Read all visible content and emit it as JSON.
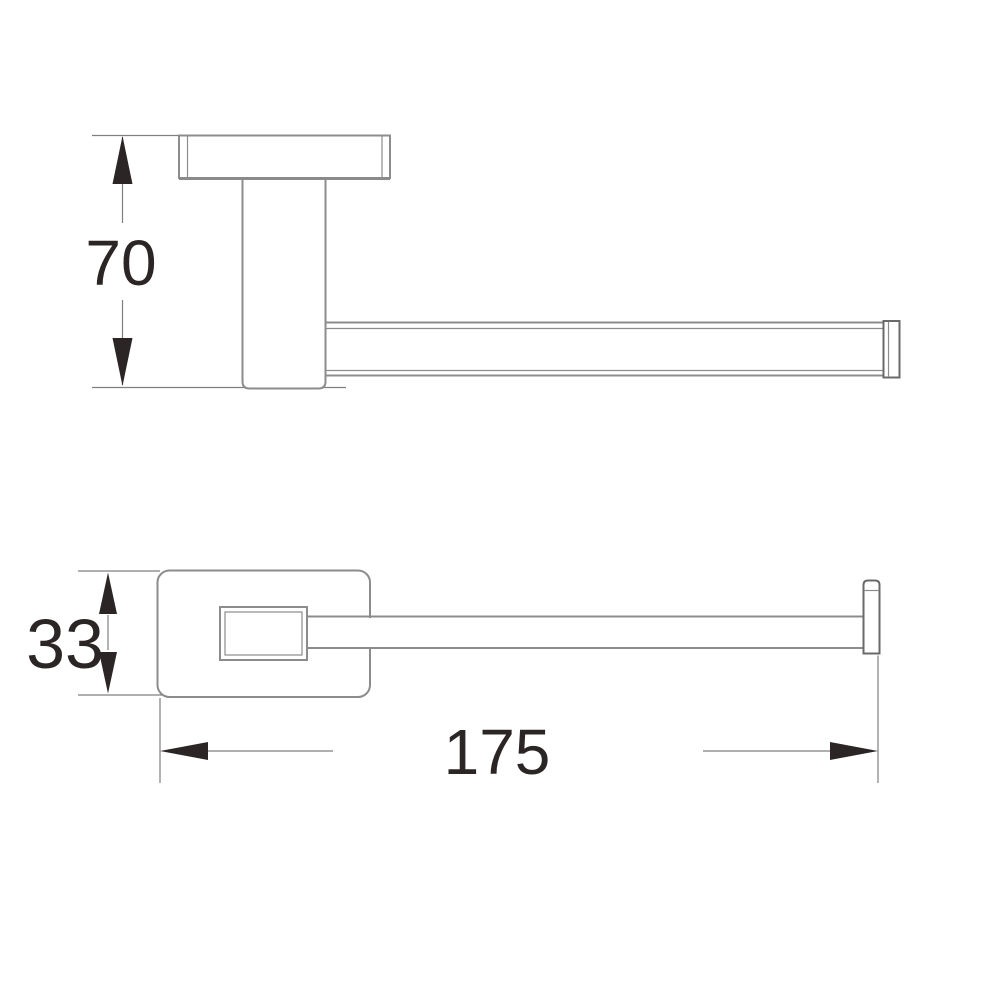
{
  "drawing": {
    "type": "technical-dimension-drawing",
    "subject": "wall-mounted towel holder, two orthographic views",
    "views": {
      "side_view": {
        "dimension_height": {
          "value": "70"
        }
      },
      "plan_view": {
        "dimension_depth": {
          "value": "33"
        },
        "dimension_length": {
          "value": "175"
        }
      }
    },
    "colors": {
      "background": "#ffffff",
      "outline": "#8c8c8c",
      "outline_dark": "#6a6a6a",
      "dimension_line": "#7f7f7f",
      "ink": "#2b2625"
    }
  }
}
